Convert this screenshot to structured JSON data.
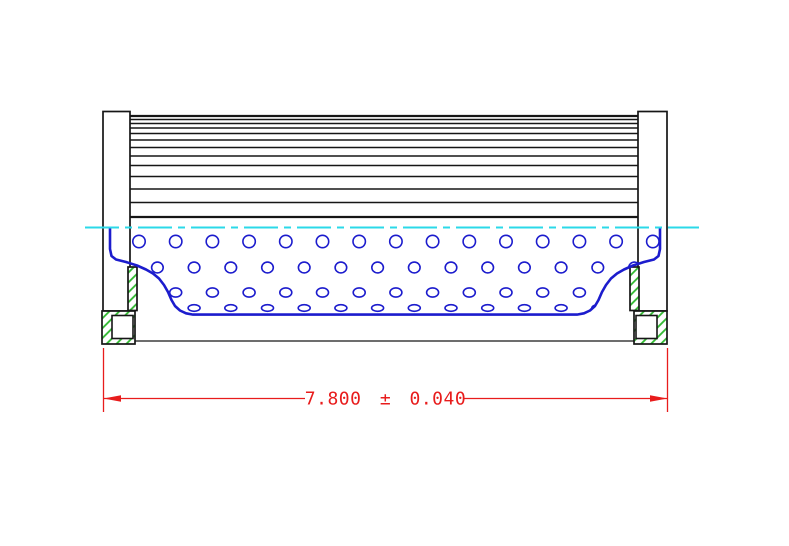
{
  "drawing": {
    "title": "filter-element-section-view",
    "dimension": {
      "label": "7.800 ± 0.040"
    },
    "colors": {
      "background": "#ffffff",
      "outline": "#161616",
      "core": "#1c1ccd",
      "centerline": "#2bd9e8",
      "hatch": "#2eb82e",
      "dimension": "#e81c1c"
    },
    "pleat_lines": {
      "x_start": 130,
      "x_end": 638,
      "ys": [
        116,
        119.5,
        123.5,
        128,
        133.5,
        140,
        147.5,
        156,
        165.5,
        176.5,
        189,
        202.5,
        217
      ]
    },
    "perforation_rows": [
      {
        "cy": 241.5,
        "rx": 6.2,
        "ry": 6.2,
        "x_start": 139.0,
        "spacing": 36.7,
        "count": 15
      },
      {
        "cy": 267.5,
        "rx": 5.8,
        "ry": 5.4,
        "x_start": 157.4,
        "spacing": 36.7,
        "count": 14
      },
      {
        "cy": 292.5,
        "rx": 6.0,
        "ry": 4.6,
        "x_start": 139.0,
        "spacing": 36.7,
        "count": 15
      },
      {
        "cy": 308.0,
        "rx": 6.0,
        "ry": 3.3,
        "x_start": 157.4,
        "spacing": 36.7,
        "count": 14
      }
    ]
  }
}
